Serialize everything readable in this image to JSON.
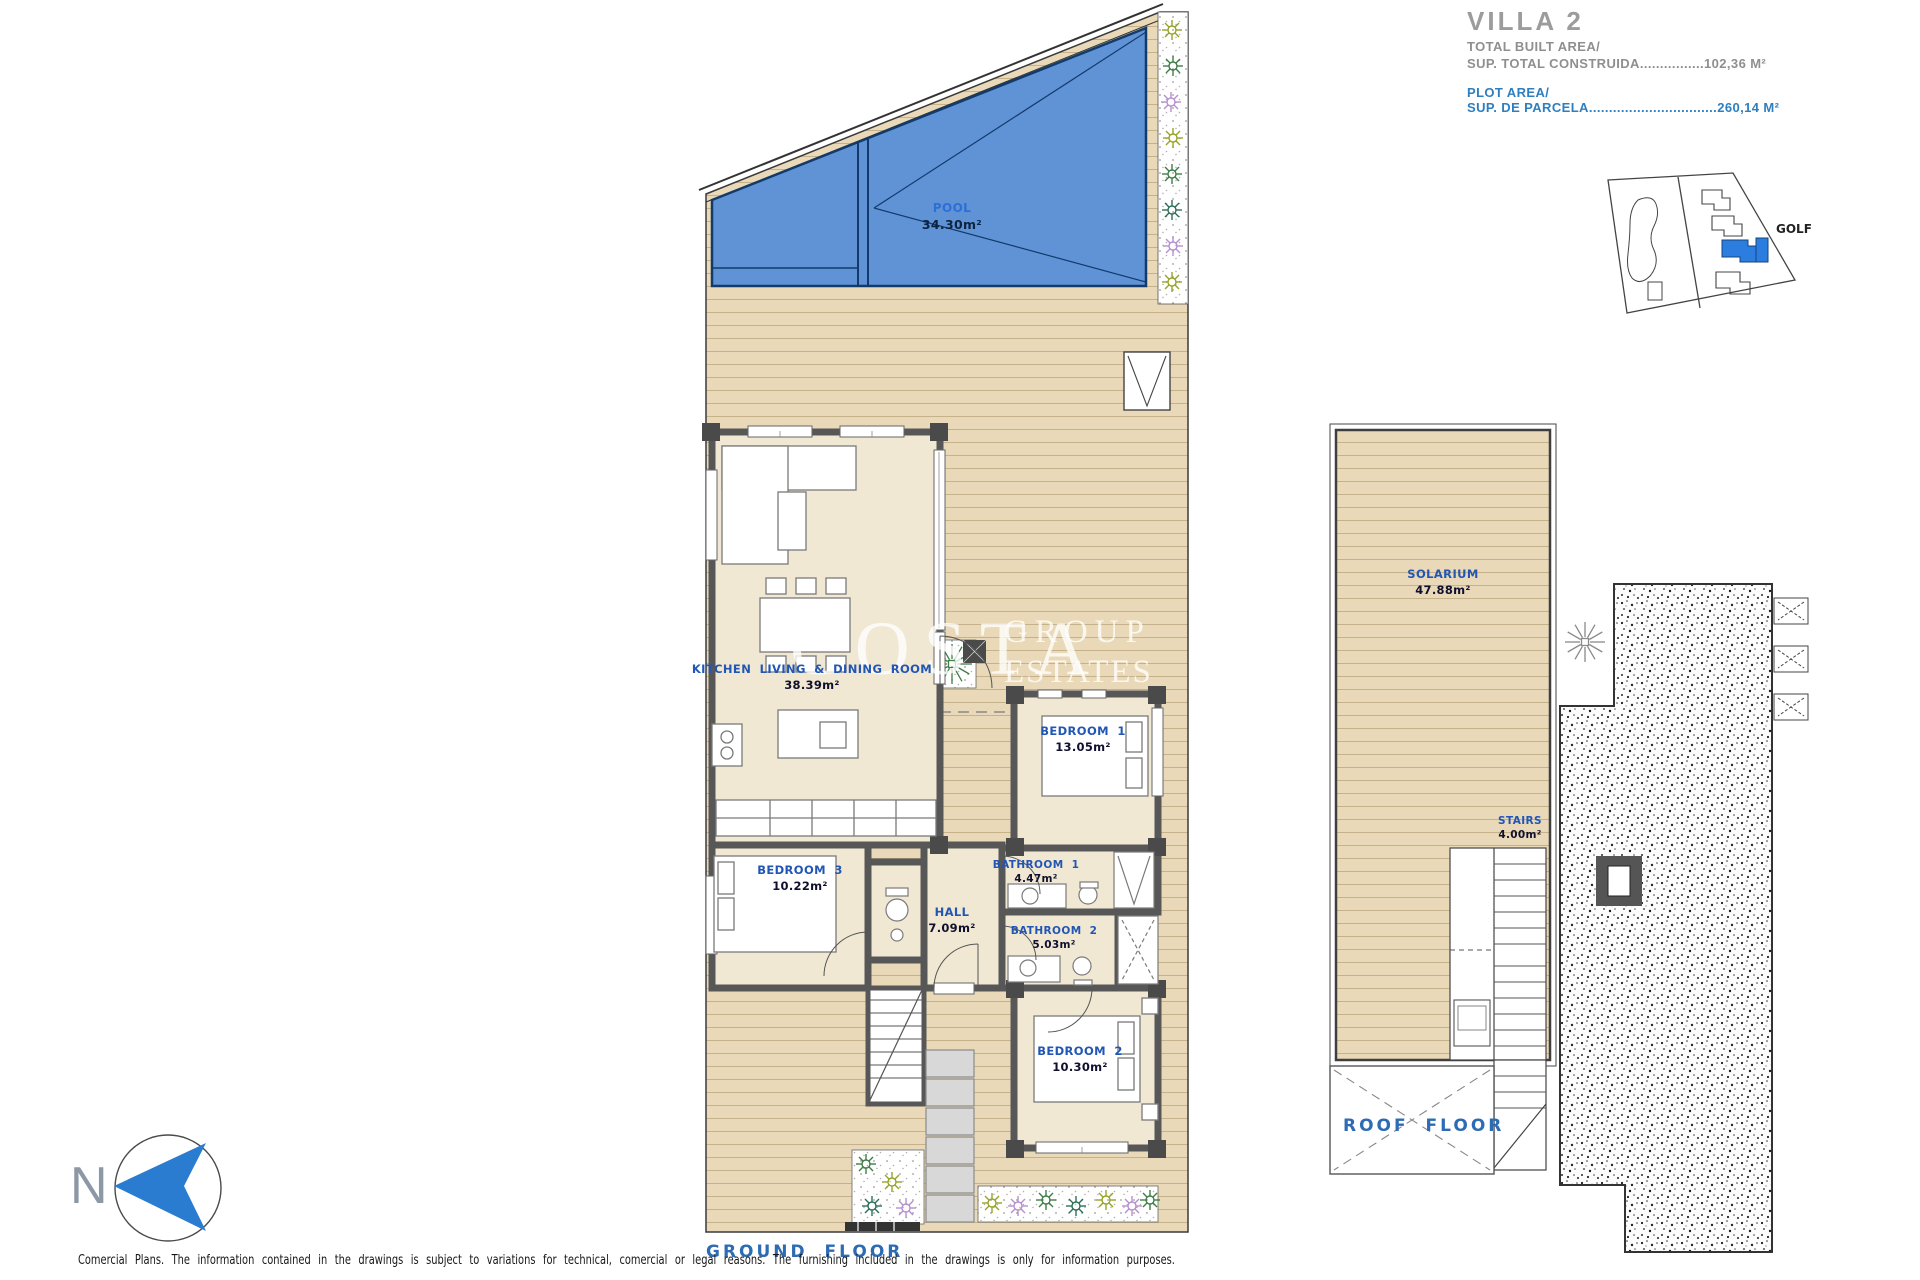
{
  "title_block": {
    "title": "VILLA 2",
    "built_area_label": "TOTAL BUILT AREA/",
    "built_area_value": "SUP. TOTAL CONSTRUIDA................102,36 M²",
    "plot_area_label": "PLOT AREA/",
    "plot_area_value": "SUP. DE PARCELA................................260,14 M²"
  },
  "site_map": {
    "golf_label": "GOLF"
  },
  "compass_north": "N",
  "watermark": {
    "word1": "COSTA",
    "word2": "GROUP",
    "word3": "ESTATES"
  },
  "ground_floor": {
    "caption": "GROUND FLOOR",
    "rooms": [
      {
        "name": "POOL",
        "area": "34.30m²"
      },
      {
        "name": "KITCHEN LIVING & DINING ROOM",
        "area": "38.39m²"
      },
      {
        "name": "BEDROOM 1",
        "area": "13.05m²"
      },
      {
        "name": "BATHROOM 1",
        "area": "4.47m²"
      },
      {
        "name": "BATHROOM 2",
        "area": "5.03m²"
      },
      {
        "name": "BEDROOM 2",
        "area": "10.30m²"
      },
      {
        "name": "BEDROOM 3",
        "area": "10.22m²"
      },
      {
        "name": "HALL",
        "area": "7.09m²"
      }
    ]
  },
  "roof_floor": {
    "caption": "ROOF FLOOR",
    "rooms": [
      {
        "name": "SOLARIUM",
        "area": "47.88m²"
      },
      {
        "name": "STAIRS",
        "area": "4.00m²"
      }
    ]
  },
  "footer": {
    "disclaimer": "Comercial Plans. The information contained in the drawings is subject to variations for technical, comercial or legal reasons. The furnishing included in the drawings is only for information purposes."
  },
  "colors": {
    "pool_blue": "#5f93d6",
    "label_blue": "#2156b4",
    "accent_blue": "#2e7fc0",
    "deck_tan": "#e9d9b8",
    "wall_gray": "#575757"
  }
}
